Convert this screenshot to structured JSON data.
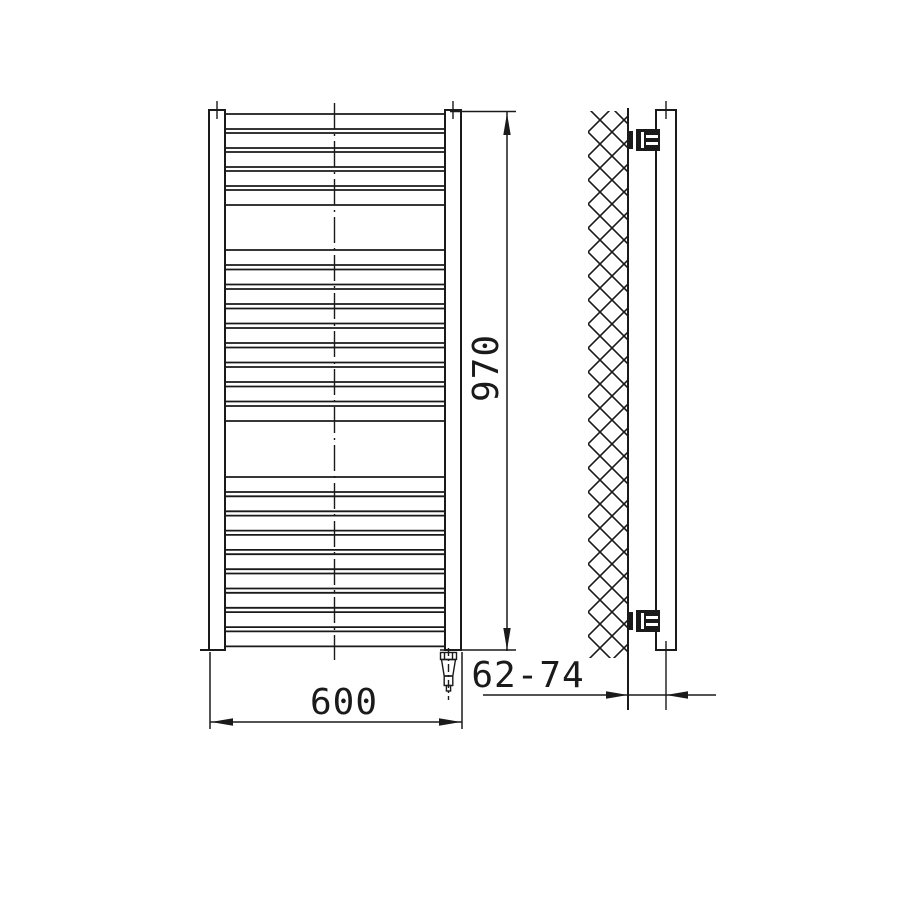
{
  "drawing": {
    "type": "technical-dimension-drawing",
    "subject": "ladder towel radiator, front and side view",
    "colors": {
      "line": "#1a1a1a",
      "background": "#ffffff"
    }
  },
  "dimensions": {
    "width_label": "600",
    "height_label": "970",
    "wall_distance_label": "62-74"
  },
  "front_view": {
    "tube_x1": 226,
    "tube_x2": 444,
    "tube_groups": [
      {
        "count": 5,
        "start_y": 114,
        "tube_h": 15,
        "gap": 4
      },
      {
        "count": 9,
        "start_y": 250,
        "tube_h": 15,
        "gap": 4.5
      },
      {
        "count": 9,
        "start_y": 477,
        "tube_h": 15,
        "gap": 4.3
      }
    ]
  }
}
